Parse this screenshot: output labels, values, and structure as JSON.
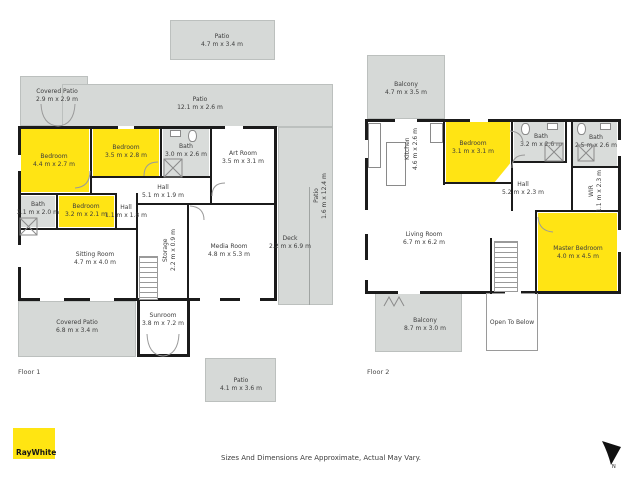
{
  "floor1": {
    "label": "Floor 1",
    "rooms": {
      "patio_top": {
        "name": "Patio",
        "dims": "4.7 m x 3.4 m"
      },
      "covered_patio_top": {
        "name": "Covered Patio",
        "dims": "2.9 m x 2.9 m"
      },
      "patio_long": {
        "name": "Patio",
        "dims": "12.1 m x 2.6 m"
      },
      "bedroom1": {
        "name": "Bedroom",
        "dims": "4.4 m x 2.7 m"
      },
      "bedroom2": {
        "name": "Bedroom",
        "dims": "3.5 m x 2.8 m"
      },
      "bath1": {
        "name": "Bath",
        "dims": "3.0 m x 2.6 m"
      },
      "art_room": {
        "name": "Art Room",
        "dims": "3.5 m x 3.1 m"
      },
      "hall": {
        "name": "Hall",
        "dims": "5.1 m x 1.9 m"
      },
      "bath2": {
        "name": "Bath",
        "dims": "2.1 m x 2.0 m"
      },
      "bedroom3": {
        "name": "Bedroom",
        "dims": "3.2 m x 2.1 m"
      },
      "hall2": {
        "name": "Hall",
        "dims": "1.1 m x 1.8 m"
      },
      "sitting_room": {
        "name": "Sitting Room",
        "dims": "4.7 m x 4.0 m"
      },
      "storage": {
        "name": "Storage",
        "dims": "2.2 m x 0.9 m"
      },
      "media_room": {
        "name": "Media Room",
        "dims": "4.8 m x 5.3 m"
      },
      "deck": {
        "name": "Deck",
        "dims": "2.2 m x 6.9 m"
      },
      "patio_side": {
        "name": "Patio",
        "dims": "1.6 m x 12.4 m"
      },
      "covered_patio_bottom": {
        "name": "Covered Patio",
        "dims": "6.8 m x 3.4 m"
      },
      "sunroom": {
        "name": "Sunroom",
        "dims": "3.8 m x 7.2 m"
      },
      "patio_bottom": {
        "name": "Patio",
        "dims": "4.1 m x 3.6 m"
      }
    }
  },
  "floor2": {
    "label": "Floor 2",
    "rooms": {
      "balcony_top": {
        "name": "Balcony",
        "dims": "4.7 m x 3.5 m"
      },
      "kitchen": {
        "name": "Kitchen",
        "dims": "4.6 m x 2.6 m"
      },
      "bedroom": {
        "name": "Bedroom",
        "dims": "3.1 m x 3.1 m"
      },
      "bath1": {
        "name": "Bath",
        "dims": "3.2 m x 2.6 m"
      },
      "bath2": {
        "name": "Bath",
        "dims": "2.5 m x 2.6 m"
      },
      "hall": {
        "name": "Hall",
        "dims": "5.2 m x 2.3 m"
      },
      "wir": {
        "name": "WIR",
        "dims": "1.1 m x 2.3 m"
      },
      "living_room": {
        "name": "Living Room",
        "dims": "6.7 m x 6.2 m"
      },
      "master_bedroom": {
        "name": "Master Bedroom",
        "dims": "4.0 m x 4.5 m"
      },
      "balcony_bottom": {
        "name": "Balcony",
        "dims": "8.7 m x 3.0 m"
      },
      "open_to_below": {
        "name": "Open To Below",
        "dims": ""
      }
    }
  },
  "footer": {
    "logo_text": "RayWhite",
    "disclaimer": "Sizes And Dimensions Are Approximate, Actual May Vary.",
    "compass_label": "N"
  },
  "colors": {
    "highlight_yellow": "#FFE414",
    "brand_yellow": "#FFE512",
    "outdoor_gray": "#D6D9D7",
    "wall_black": "#1B1B1B"
  }
}
